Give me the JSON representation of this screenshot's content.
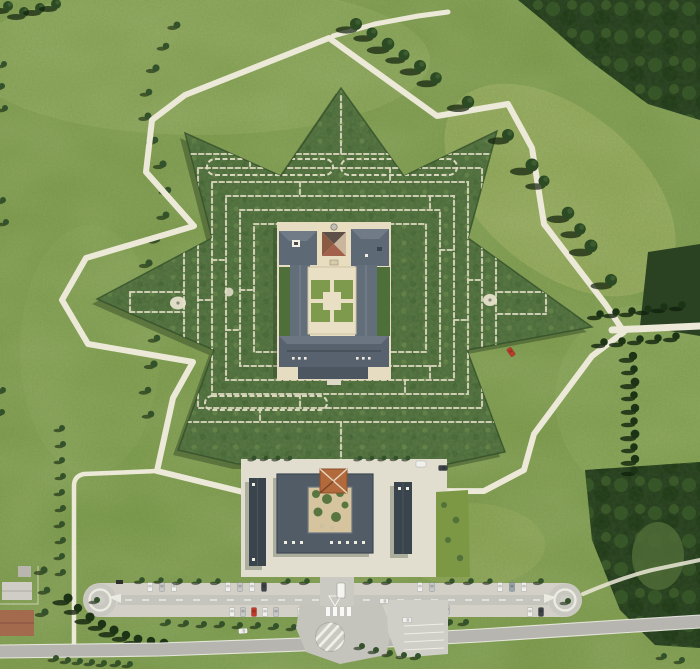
{
  "meta": {
    "type": "aerial-photograph",
    "subject": "Top-down aerial view of a star-shaped bamboo labyrinth estate with a central villa, pyramidal chapel, entrance courtyard building, tree-lined lanes, twin-roundabout visitor parking and perimeter roads",
    "width_px": 700,
    "height_px": 669
  },
  "palette": {
    "field_base": "#7d9c4b",
    "field_light": "#93ad5c",
    "meadow_bright": "#a6b765",
    "bamboo": "#4c6c3a",
    "bamboo_dark": "#2f4d26",
    "forest": "#263c1e",
    "path_white": "#ece9d8",
    "maze_path": "#dbd7bf",
    "pavement": "#d2d0c7",
    "asphalt": "#c4c3bc",
    "road": "#b6b5af",
    "apron": "#e1ded0",
    "courtyard": "#e9dfc5",
    "roof_slate": "#5d6975",
    "roof_dark": "#515c66",
    "wing_dark": "#39444c",
    "terracotta": "#a3604a",
    "skylight_orange": "#b26a3c",
    "tree_dark": "#2c4a24",
    "shadow": "#15240f",
    "car_red": "#c03a2c",
    "car_white": "#f0f0ec",
    "car_silver": "#c7c9c8"
  },
  "scene": {
    "labyrinth": {
      "shape": "eight-point star hedge maze",
      "hedge": "bamboo",
      "features": [
        "concentric rectangular maze corridors",
        "double-hedge straight corridors at north and south",
        "west clearing chamber",
        "east clearing chamber",
        "white gravel perimeter ring path"
      ]
    },
    "villa": {
      "parts": [
        "north-west hip-roof wing",
        "pyramidal chapel with small dome",
        "north-east hip-roof wing",
        "cloister courtyard with four parterre squares forming a cross",
        "south slate range"
      ]
    },
    "entrance_building": {
      "parts": [
        "square block around planted courtyard",
        "terracotta pyramidal skylight",
        "detached west wing",
        "detached east wing",
        "roof skylight dots"
      ]
    },
    "grounds": {
      "roads": [
        "perimeter gravel ring around star",
        "north-east spur path",
        "east tree-lined lane",
        "south-west farm path",
        "south public road with junction and striped traffic island"
      ],
      "parking": {
        "layout": "long double-row strip with circular turnarounds at both ends",
        "west_roundabouts": 1,
        "east_roundabouts": 1,
        "visible_vehicles": 33
      },
      "vegetation": [
        "dark forest block north-east",
        "forest block south-east",
        "diagonal tree row with long shadows",
        "cypress row on east field",
        "wavy hedgerow on west fields",
        "conifer cluster by west roundabout"
      ],
      "buildings_other": [
        "farm houses with terracotta and grey roofs at south-west corner"
      ]
    },
    "lighting": "sunlit, shadows cast toward lower-left"
  }
}
